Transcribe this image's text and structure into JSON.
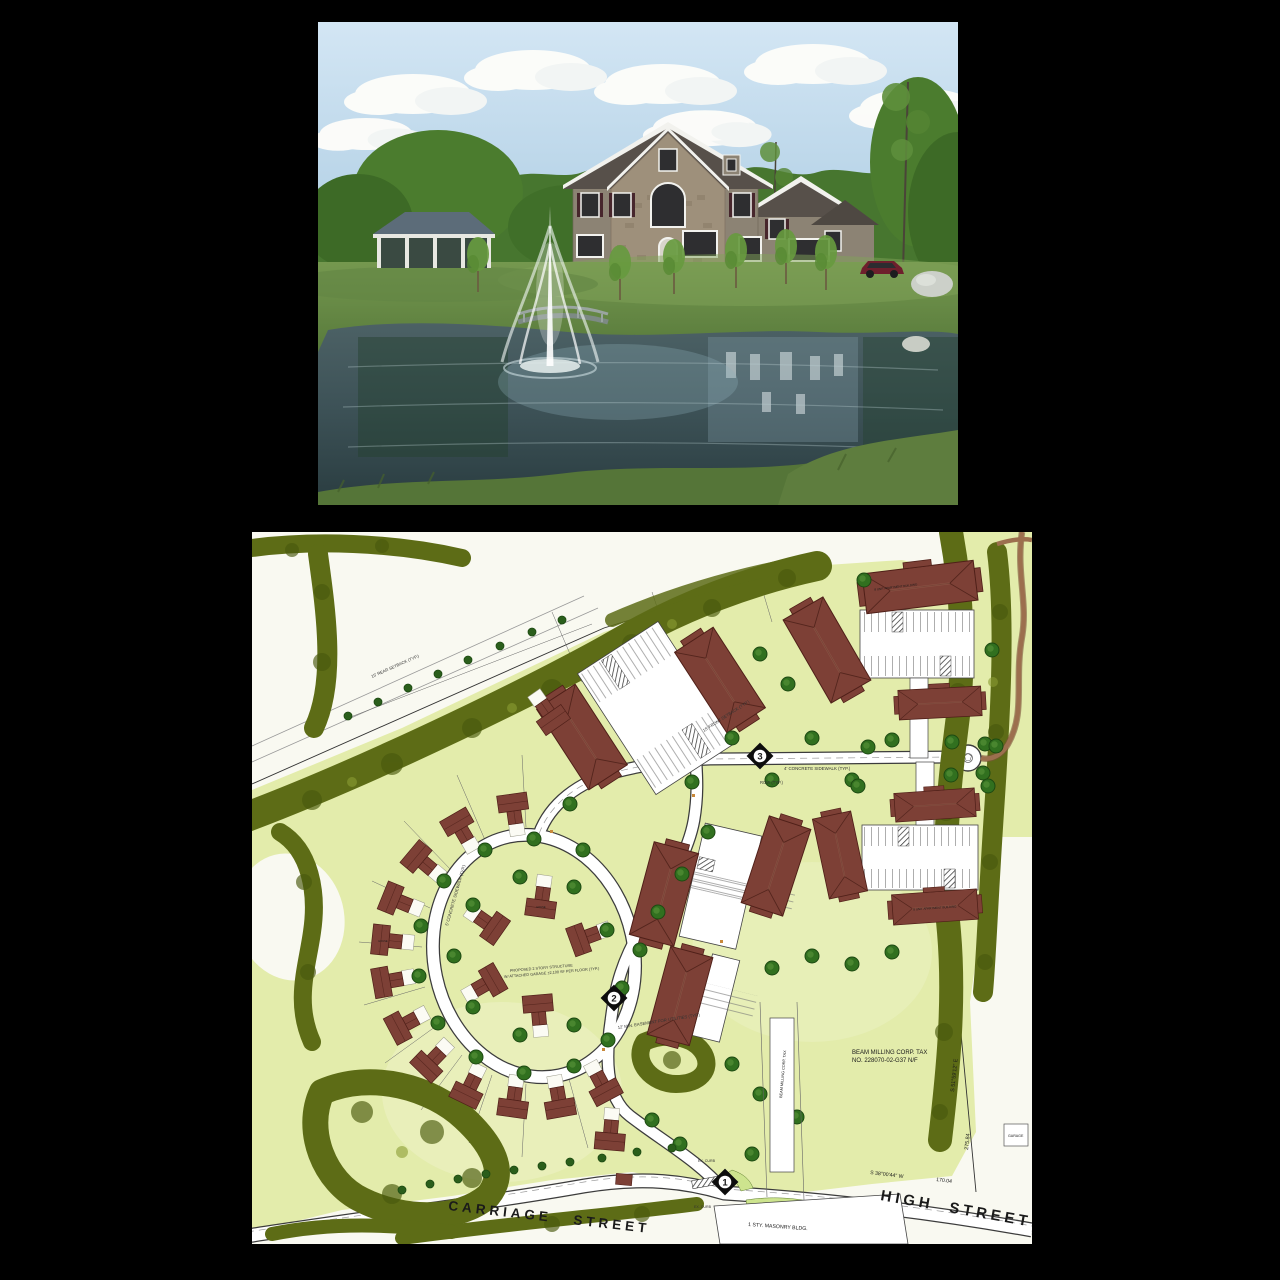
{
  "page": {
    "background": "#000000"
  },
  "photo": {
    "colors": {
      "sky_top": "#d3e6f4",
      "sky_bottom": "#a3c6de",
      "cloud": "#fdfdfa",
      "far_trees": "#47762f",
      "lawn": "#6a9048",
      "pond": "#40545a",
      "roof": "#57504a",
      "siding": "#8c8374",
      "stone": "#9e907b",
      "shutter": "#47262c",
      "trim": "#f2f2ee",
      "car": "#6e1f2c",
      "boulder": "#ccd0c9",
      "pavilion_roof": "#5c6c79",
      "fountain": "#ffffff"
    }
  },
  "site_plan": {
    "streets": {
      "carriage": "CARRIAGE STREET",
      "high": "HIGH STREET"
    },
    "markers": {
      "m1": "1",
      "m2": "2",
      "m3": "3"
    },
    "parcel_note": {
      "line1": "BEAM MILLING CORP. TAX",
      "line2": "NO. 228070-02-G37 N/F"
    },
    "labels": {
      "masonry_building": "1 STY. MASONRY BLDG.",
      "garage": "GARAGE",
      "apartment_building": "8 UNIT APARTMENT BUILDING",
      "house": "HOUSE"
    },
    "bearings": {
      "east_line": "S 51°59'12\" E",
      "east_dim": "275.84",
      "south_line": "S 38°00'44\" W",
      "south_dim": "170.04"
    },
    "annotations": {
      "sidewalk4": "4' CONCRETE SIDEWALK (TYP.)",
      "sidewalk5": "5' CONCRETE SIDEWALK (TYP.)",
      "row": "ROW (TYP.)",
      "easement": "12' MIN. EASEMENT FOR UTILITIES (TYP.)",
      "structure1": "PROPOSED 2 STORY STRUCTURE",
      "structure2": "W/ ATTACHED GARAGE ±2,100 SF PER FLOOR (TYP.)",
      "front_setback": "15' FRONT SETBACK (TYP.)",
      "rear_setback": "15' REAR SETBACK (TYP.)",
      "ex_curb": "EX. CURB"
    },
    "colors": {
      "paper": "#f9f9f1",
      "lawn": "#e3ecab",
      "hedge": "#5d6c16",
      "building": "#7d4036",
      "tree": "#31701f",
      "trail": "#9c6f4e",
      "road": "#ffffff",
      "marker": "#0d0d0d"
    }
  }
}
